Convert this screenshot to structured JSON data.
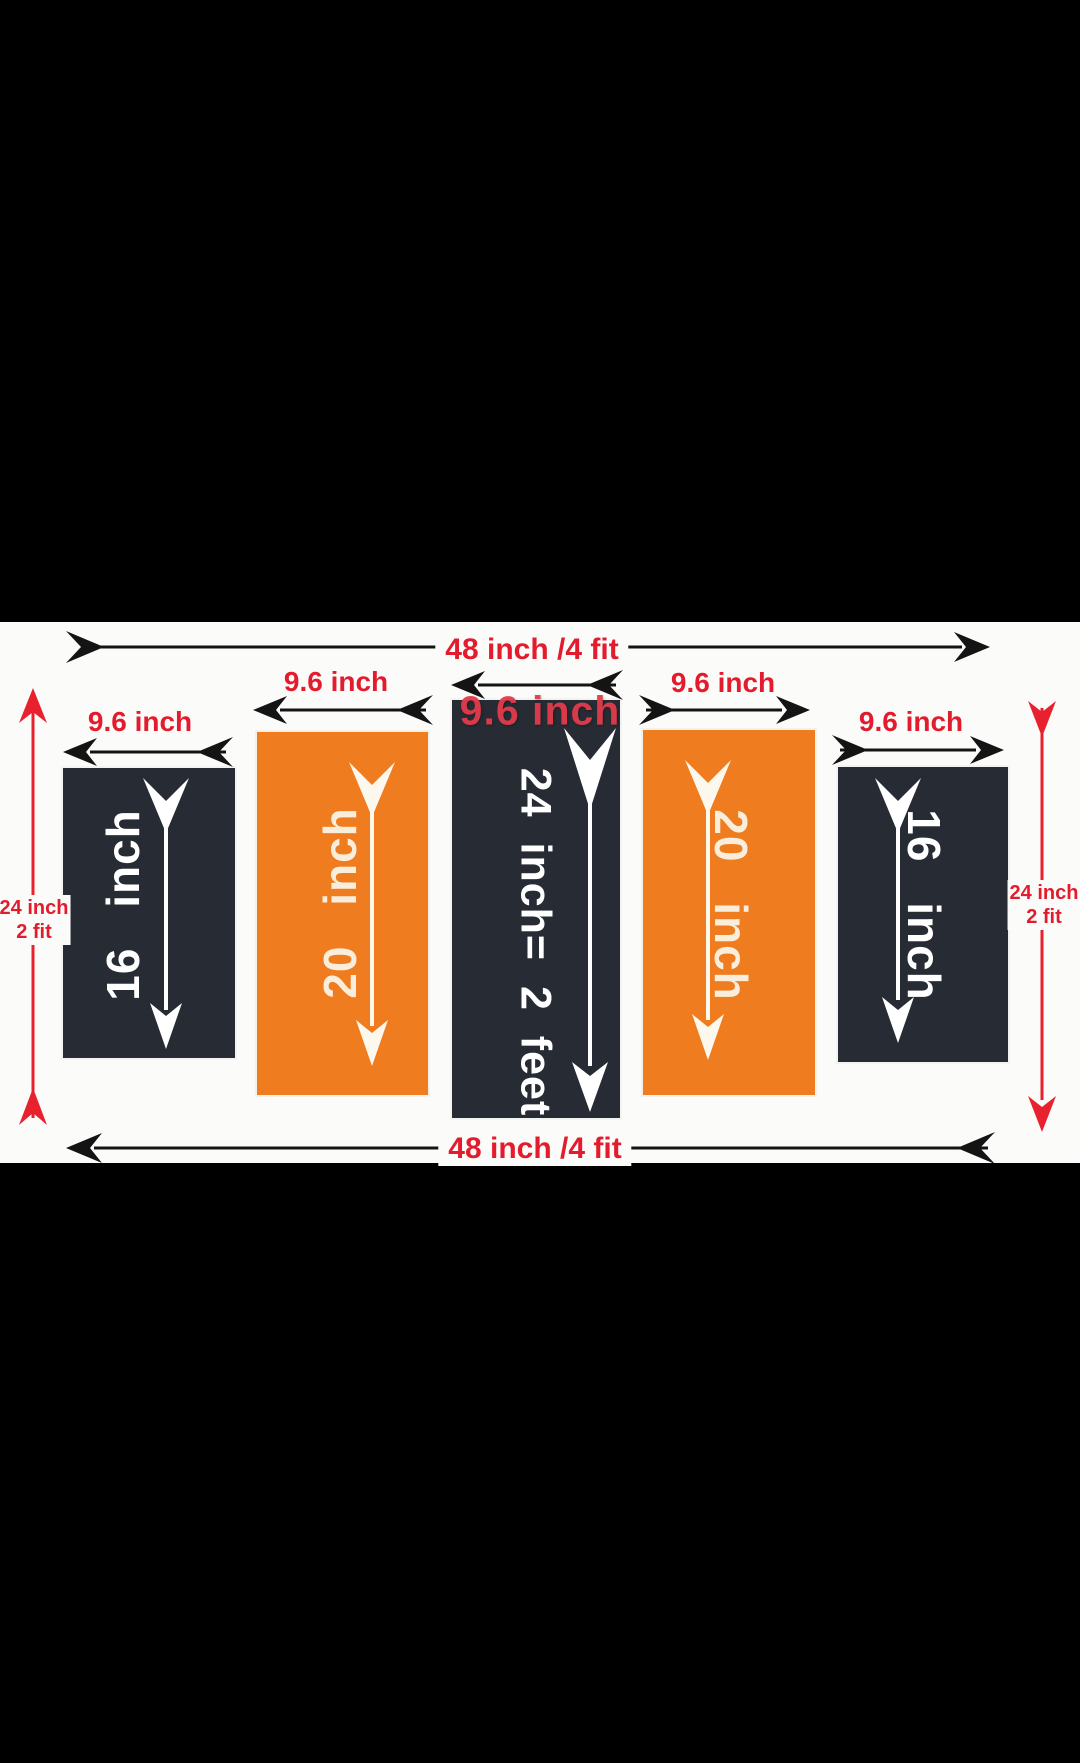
{
  "diagram_title": "five panel wall size diagram",
  "colors": {
    "letterbox": "#000000",
    "background": "#fbfbfa",
    "panel_dark": "#262b34",
    "panel_orange": "#f07c20",
    "label_red": "#e31c2d",
    "watermark_red": "#e33c4b",
    "panel_text_white": "#ffffff",
    "panel_text_cream": "#f8eedb",
    "dimension_arrow_black": "#141414",
    "side_arrow_red": "#e8212f"
  },
  "dimensions": {
    "top": {
      "label": "48 inch /4 fit"
    },
    "bottom": {
      "label": "48 inch /4 fit"
    },
    "left": {
      "line1": "24 inch",
      "line2": "2 fit"
    },
    "right": {
      "line1": "24 inch",
      "line2": "2 fit"
    }
  },
  "panels": [
    {
      "height_label": "16 inch",
      "width_label": "9.6 inch",
      "fill": "#262b34"
    },
    {
      "height_label": "20 inch",
      "width_label": "9.6 inch",
      "fill": "#f07c20"
    },
    {
      "height_label": "24 inch= 2 feet",
      "width_label": "9.6 inch",
      "fill": "#262b34"
    },
    {
      "height_label": "20 inch",
      "width_label": "9.6 inch",
      "fill": "#f07c20"
    },
    {
      "height_label": "16 inch",
      "width_label": "9.6 inch",
      "fill": "#262b34"
    }
  ]
}
